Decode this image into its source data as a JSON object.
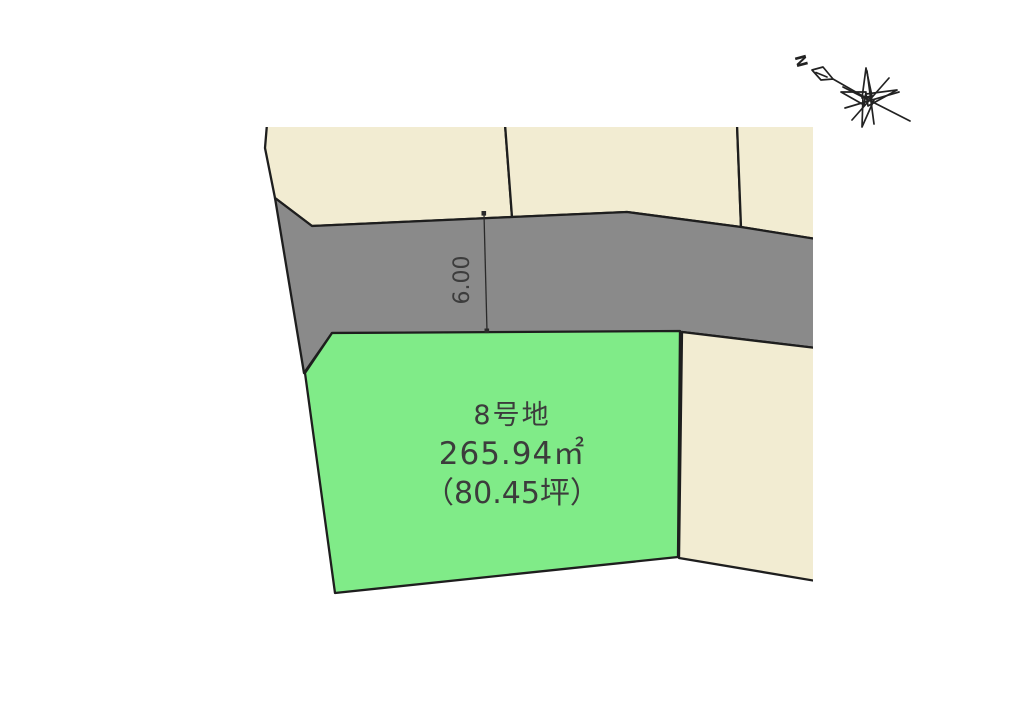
{
  "colors": {
    "neighbor": "#F2ECD2",
    "road": "#8A8A8A",
    "featured": "#80EB88",
    "stroke": "#1E1E1E",
    "text": "#3C3C3C",
    "dimension_line": "#2A2A2A",
    "background": "#FFFFFF"
  },
  "featured_lot": {
    "name": "8号地",
    "area_m2": "265.94㎡",
    "area_tsubo": "（80.45坪）"
  },
  "dimension": {
    "label": "6.00"
  },
  "compass": {
    "label": "N"
  },
  "parcels": [
    {
      "id": "neighbor-lot-top-left",
      "type": "neighbor",
      "points": [
        [
          267,
          124
        ],
        [
          505,
          124
        ],
        [
          512,
          217
        ],
        [
          312,
          226
        ],
        [
          275,
          198
        ],
        [
          265,
          148
        ]
      ]
    },
    {
      "id": "neighbor-lot-top-middle",
      "type": "neighbor",
      "points": [
        [
          505,
          124
        ],
        [
          737,
          124
        ],
        [
          741,
          227
        ],
        [
          627,
          212
        ],
        [
          512,
          217
        ]
      ]
    },
    {
      "id": "neighbor-lot-top-right",
      "type": "neighbor",
      "points": [
        [
          737,
          124
        ],
        [
          816,
          124
        ],
        [
          816,
          239
        ],
        [
          741,
          227
        ]
      ]
    },
    {
      "id": "road",
      "type": "road",
      "points": [
        [
          275,
          198
        ],
        [
          312,
          226
        ],
        [
          512,
          217
        ],
        [
          627,
          212
        ],
        [
          741,
          227
        ],
        [
          816,
          239
        ],
        [
          816,
          348
        ],
        [
          682,
          332
        ],
        [
          332,
          333
        ],
        [
          304,
          373
        ]
      ]
    },
    {
      "id": "lot-8",
      "type": "featured",
      "points": [
        [
          332,
          333
        ],
        [
          680,
          331
        ],
        [
          678,
          557
        ],
        [
          335,
          593
        ],
        [
          305,
          373
        ]
      ]
    },
    {
      "id": "neighbor-lot-bottom-right",
      "type": "neighbor",
      "points": [
        [
          682,
          332
        ],
        [
          816,
          348
        ],
        [
          816,
          581
        ],
        [
          679,
          558
        ]
      ]
    }
  ]
}
